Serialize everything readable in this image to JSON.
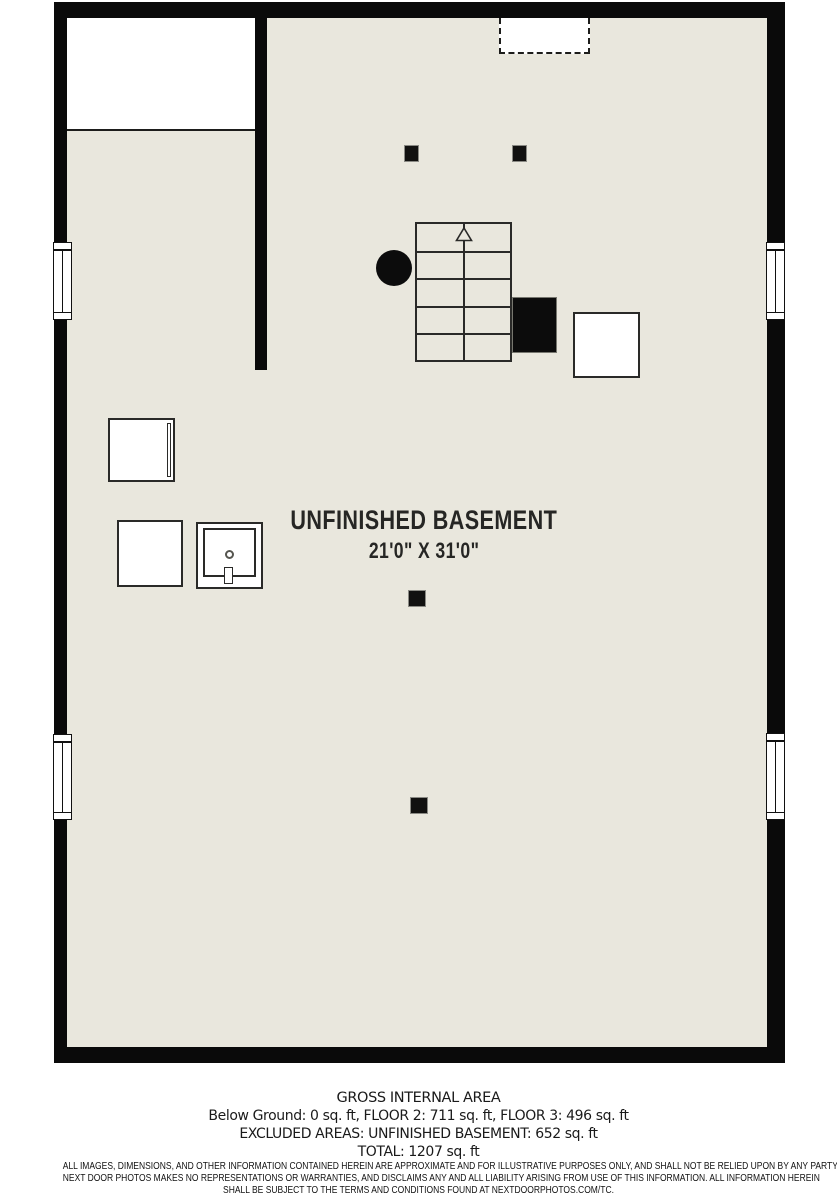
{
  "floorplan": {
    "room_label": "UNFINISHED BASEMENT",
    "room_dimensions": "21'0\" X 31'0\"",
    "features": [
      "staircase-with-up-arrow",
      "support-post-x4",
      "pipe-column",
      "furnace",
      "water-heater",
      "appliance-box",
      "storage-box",
      "utility-sink",
      "window-x4",
      "dashed-opening",
      "closet-area"
    ],
    "colors": {
      "floor": "#e9e7dd",
      "wall": "#0a0a0a",
      "fixture_fill": "#ffffff",
      "line": "#2a2a28",
      "background": "#ffffff"
    }
  },
  "footer": {
    "title": "GROSS INTERNAL AREA",
    "lines": [
      "Below Ground: 0 sq. ft, FLOOR 2: 711 sq. ft, FLOOR 3: 496 sq. ft",
      "EXCLUDED AREAS: UNFINISHED BASEMENT: 652 sq. ft",
      "TOTAL: 1207 sq. ft"
    ],
    "areas": {
      "below_ground_sqft": 0,
      "floor_2_sqft": 711,
      "floor_3_sqft": 496,
      "excluded_unfinished_basement_sqft": 652,
      "total_sqft": 1207
    }
  },
  "disclaimer": {
    "lines": [
      "ALL IMAGES, DIMENSIONS, AND OTHER INFORMATION CONTAINED HEREIN ARE APPROXIMATE AND FOR ILLUSTRATIVE PURPOSES ONLY, AND SHALL NOT BE RELIED UPON BY ANY PARTY.",
      "NEXT DOOR PHOTOS MAKES NO REPRESENTATIONS OR WARRANTIES, AND DISCLAIMS ANY AND ALL LIABILITY ARISING FROM USE OF THIS INFORMATION. ALL INFORMATION HEREIN",
      "SHALL BE SUBJECT TO THE TERMS AND CONDITIONS FOUND AT NEXTDOORPHOTOS.COM/TC."
    ]
  }
}
